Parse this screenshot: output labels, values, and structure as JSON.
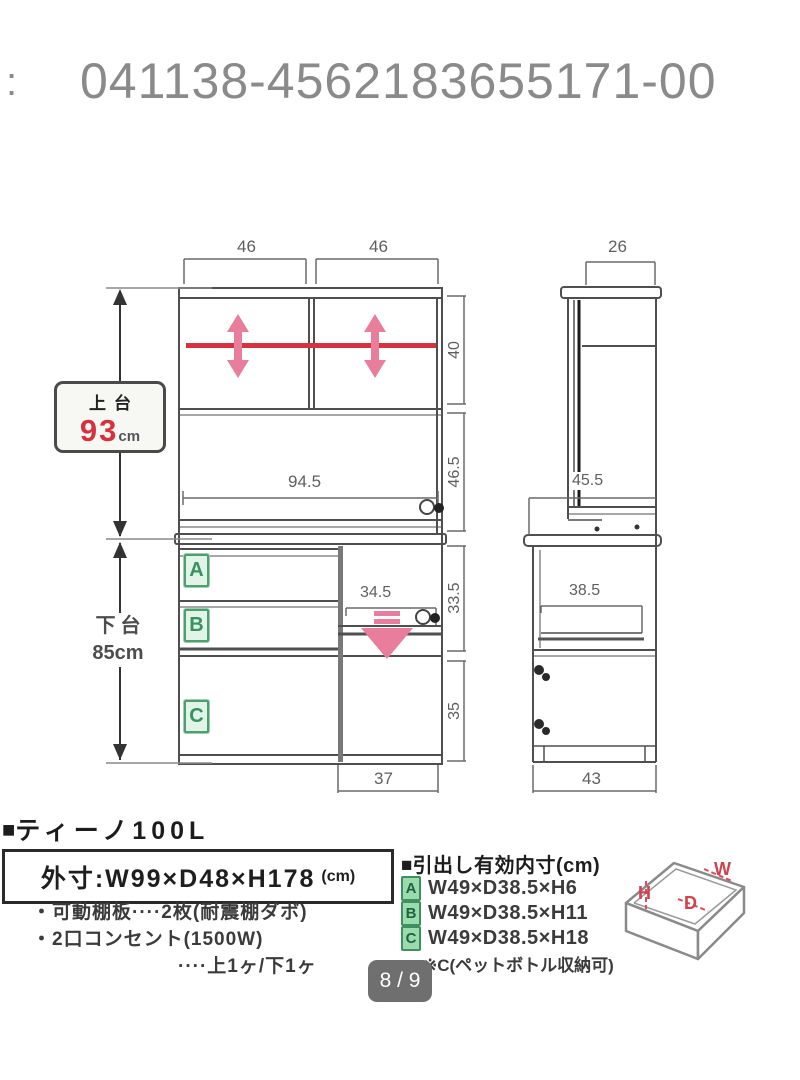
{
  "header": {
    "colon": ":",
    "code": "041138-4562183655171-00"
  },
  "front_view": {
    "dim_top_left": "46",
    "dim_top_right": "46",
    "dim_shelf_height": "40",
    "dim_open_height": "46.5",
    "dim_drawer_height": "33.5",
    "dim_door_height": "35",
    "dim_counter_width": "94.5",
    "dim_tray_width": "34.5",
    "dim_door_width": "37",
    "badges": [
      "A",
      "B",
      "C"
    ],
    "upper_label": {
      "name": "上台",
      "value": "93",
      "unit": "cm"
    },
    "lower_label": {
      "name": "下台",
      "value": "85cm"
    }
  },
  "side_view": {
    "dim_top_depth": "26",
    "dim_counter_depth": "45.5",
    "dim_tray_depth": "38.5",
    "dim_base_depth": "43"
  },
  "product": {
    "bullet": "■",
    "name": "ティーノ100L",
    "size_label": "外寸:W99×D48×H178",
    "size_unit": "(cm)",
    "features": [
      "・可動棚板····2枚(耐震棚ダボ)",
      "・2口コンセント(1500W)",
      "····上1ヶ/下1ヶ"
    ]
  },
  "drawer_specs": {
    "bullet": "■",
    "heading": "引出し有効内寸(cm)",
    "rows": [
      {
        "label": "A",
        "size": "W49×D38.5×H6"
      },
      {
        "label": "B",
        "size": "W49×D38.5×H11"
      },
      {
        "label": "C",
        "size": "W49×D38.5×H18"
      }
    ],
    "note": "※C(ペットボトル収納可)",
    "axes": {
      "w": "W",
      "d": "D",
      "h": "H"
    }
  },
  "pager": {
    "text": "8 / 9"
  }
}
